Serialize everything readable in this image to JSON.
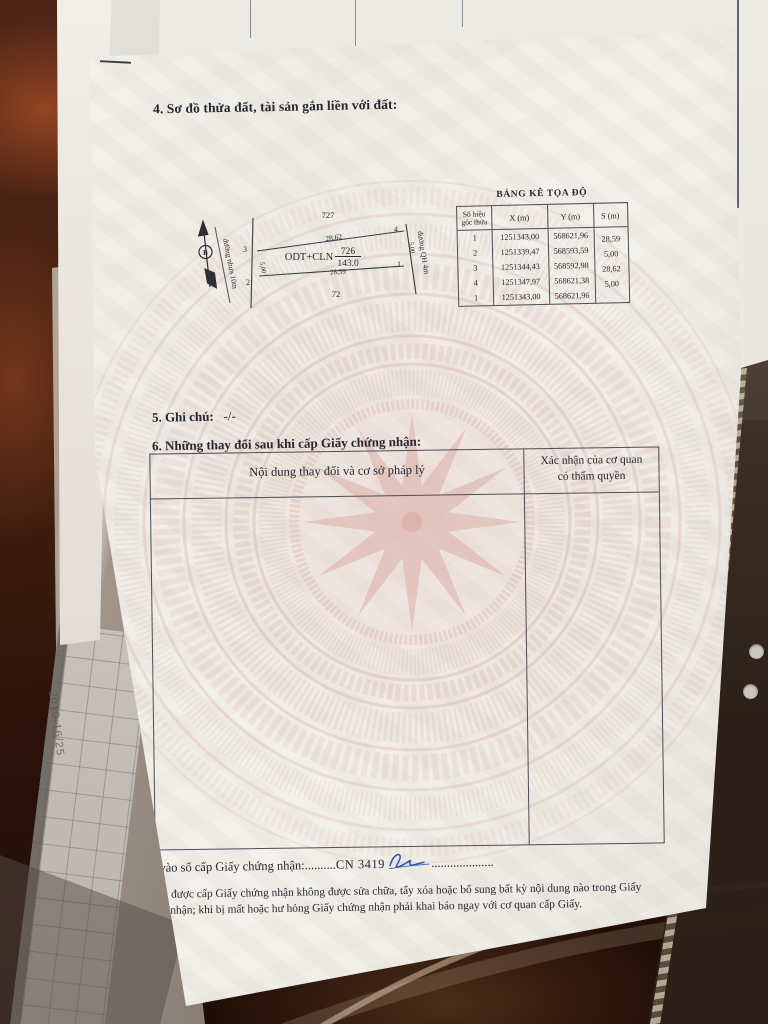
{
  "colors": {
    "paper": "#f2efe9",
    "watermark_pink": "#d6a29a",
    "wood_table": "#3d1c0e",
    "ink": "#26262e",
    "signature_blue": "#2a4fae"
  },
  "background": {
    "sleeve_stamp": "2010-16/25"
  },
  "document": {
    "section4_title": "4. Sơ đồ thửa đất, tài sản gắn liền với đất:",
    "diagram": {
      "north_label": "B",
      "left_road_label": "đường nhựa 10m",
      "right_road_label": "đường QH 4m",
      "adjacent_plot_top": "727",
      "adjacent_plot_bottom": "72",
      "plot_use_label": "ODT+CLN",
      "plot_number": "726",
      "plot_area": "143.0",
      "edge_top": "28,62",
      "edge_bottom": "28,59",
      "edge_left": "5,00",
      "edge_right": "5,00",
      "corner_1": "1",
      "corner_2": "2",
      "corner_3": "3",
      "corner_4": "4"
    },
    "coord_table": {
      "title": "BẢNG KÊ TỌA ĐỘ",
      "headers": {
        "corner_line1": "Số hiệu",
        "corner_line2": "góc thửa",
        "x": "X (m)",
        "y": "Y (m)",
        "s": "S (m)"
      },
      "rows": [
        {
          "id": "1",
          "x": "1251343,00",
          "y": "568621,96"
        },
        {
          "id": "2",
          "x": "1251339,47",
          "y": "568593,59"
        },
        {
          "id": "3",
          "x": "1251344,43",
          "y": "568592,98"
        },
        {
          "id": "4",
          "x": "1251347,97",
          "y": "568621,38"
        },
        {
          "id": "1",
          "x": "1251343,00",
          "y": "568621,96"
        }
      ],
      "s_values": [
        "28,59",
        "5,00",
        "28,62",
        "5,00"
      ]
    },
    "section5_label": "5. Ghi chú:",
    "section5_value": "-/-",
    "section6_title": "6. Những thay đổi sau khi cấp Giấy chứng nhận:",
    "changes_table": {
      "col1_header": "Nội dung thay đổi và cơ sở pháp lý",
      "col2_header_line1": "Xác nhận của cơ quan",
      "col2_header_line2": "có thẩm quyền"
    },
    "registry": {
      "label": "Số vào sổ cấp Giấy chứng nhận:",
      "dots_left": "..........",
      "number": "CN 3419",
      "dots_right": "...................."
    },
    "footer_note_line1": "Người được cấp Giấy chứng nhận không được sửa chữa, tẩy xóa hoặc bổ sung bất kỳ nội dung nào trong",
    "footer_note_line2": "Giấy chứng nhận; khi bị mất hoặc hư hỏng Giấy chứng nhận phải khai báo ngay với cơ quan cấp Giấy."
  }
}
